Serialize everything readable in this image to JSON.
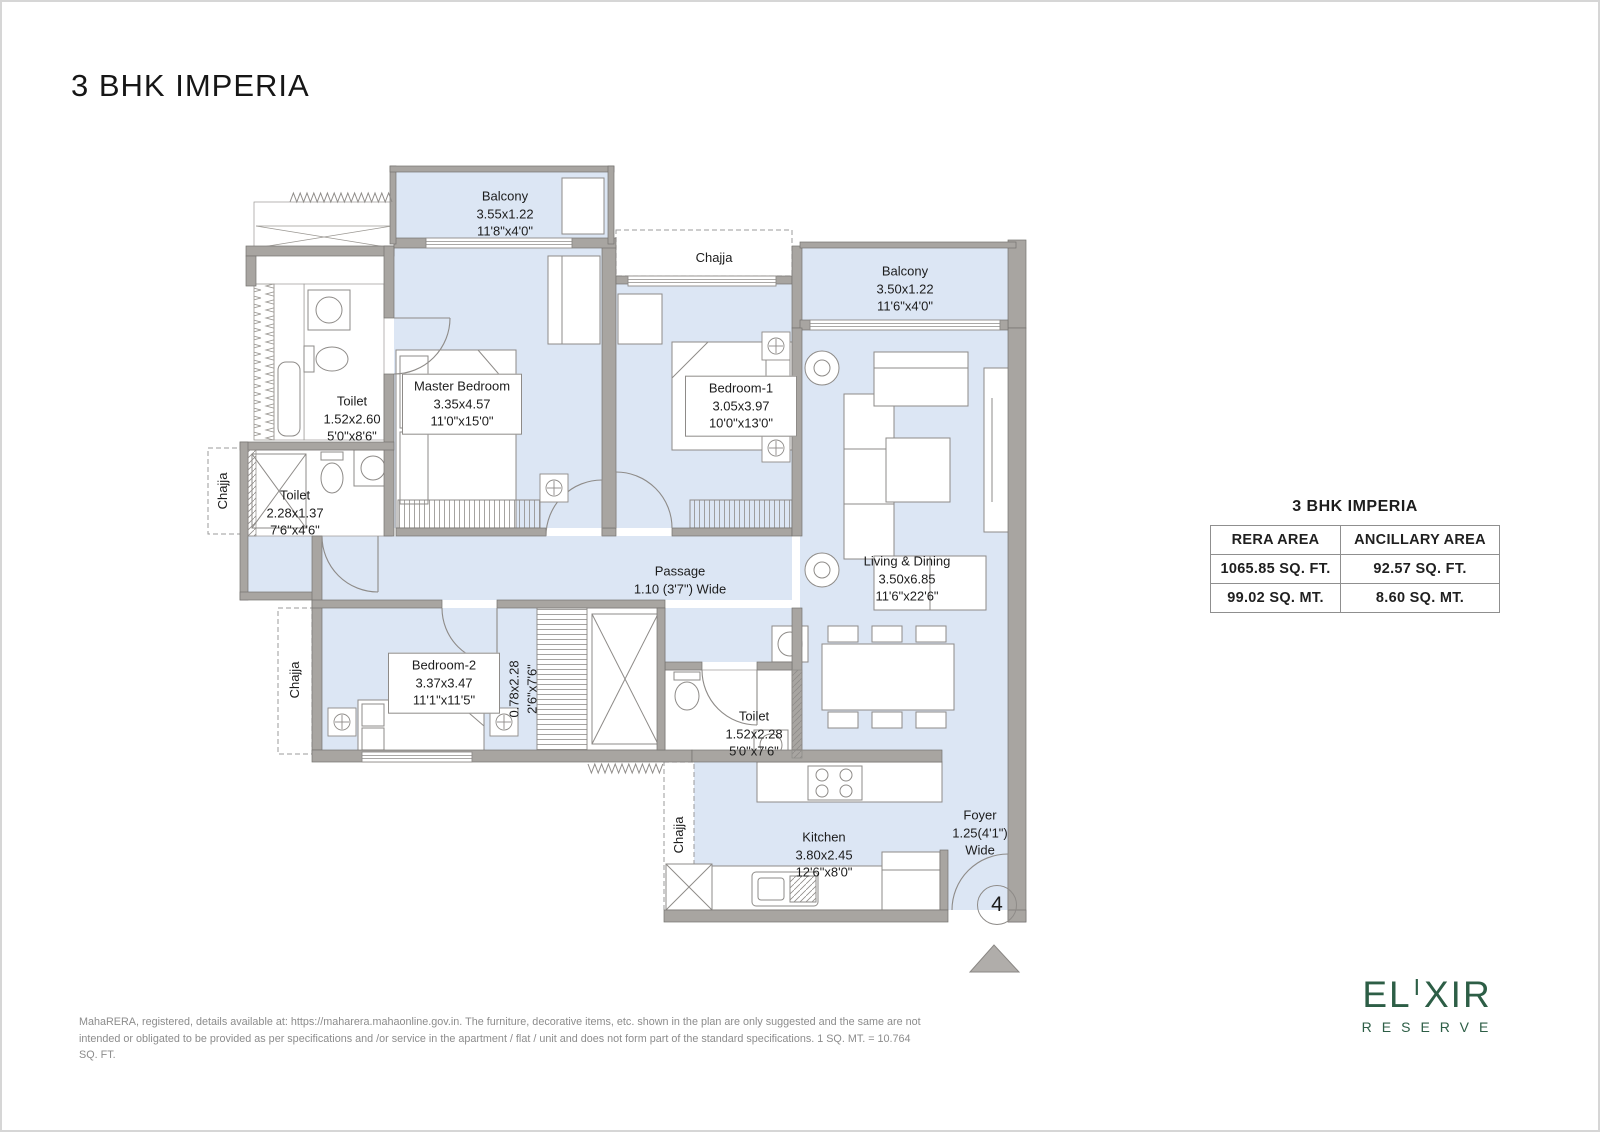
{
  "page": {
    "title": "3 BHK IMPERIA"
  },
  "plan": {
    "labels": {
      "balcony_top": {
        "name": "Balcony",
        "metric": "3.55x1.22",
        "imperial": "11'8\"x4'0\""
      },
      "chajja_top": {
        "name": "Chajja"
      },
      "balcony_right": {
        "name": "Balcony",
        "metric": "3.50x1.22",
        "imperial": "11'6\"x4'0\""
      },
      "toilet_master": {
        "name": "Toilet",
        "metric": "1.52x2.60",
        "imperial": "5'0\"x8'6\""
      },
      "toilet_common": {
        "name": "Toilet",
        "metric": "2.28x1.37",
        "imperial": "7'6\"x4'6\""
      },
      "master_bedroom": {
        "name": "Master Bedroom",
        "metric": "3.35x4.57",
        "imperial": "11'0\"x15'0\""
      },
      "bedroom_1": {
        "name": "Bedroom-1",
        "metric": "3.05x3.97",
        "imperial": "10'0\"x13'0\""
      },
      "bedroom_2": {
        "name": "Bedroom-2",
        "metric": "3.37x3.47",
        "imperial": "11'1\"x11'5\""
      },
      "chajja_left": {
        "name": "Chajja"
      },
      "chajja_left_lower": {
        "name": "Chajja"
      },
      "chajja_bottom": {
        "name": "Chajja"
      },
      "passage": {
        "name": "Passage",
        "dims": "1.10 (3'7\") Wide"
      },
      "living_dining": {
        "name": "Living & Dining",
        "metric": "3.50x6.85",
        "imperial": "11'6\"x22'6\""
      },
      "wardrobe": {
        "metric": "0.78x2.28",
        "imperial": "2'6\"x7'6\""
      },
      "toilet_bed2": {
        "name": "Toilet",
        "metric": "1.52x2.28",
        "imperial": "5'0\"x7'6\""
      },
      "kitchen": {
        "name": "Kitchen",
        "metric": "3.80x2.45",
        "imperial": "12'6\"x8'0\""
      },
      "foyer": {
        "name": "Foyer",
        "dims": "1.25(4'1\")",
        "dims2": "Wide"
      },
      "unit_number": "4"
    }
  },
  "area_table": {
    "title": "3 BHK IMPERIA",
    "col1_header": "RERA AREA",
    "col2_header": "ANCILLARY AREA",
    "rows": [
      {
        "rera": "1065.85 SQ. FT.",
        "ancillary": "92.57 SQ. FT."
      },
      {
        "rera": "99.02 SQ. MT.",
        "ancillary": "8.60 SQ. MT."
      }
    ]
  },
  "footer": {
    "disclaimer": "MahaRERA, registered, details available at: https://maharera.mahaonline.gov.in. The furniture, decorative items, etc. shown in the plan are only suggested and the same are not intended or obligated to be provided as per specifications and /or service in the apartment / flat / unit and does not form part of the standard specifications. 1 SQ. MT. = 10.764 SQ. FT."
  },
  "logo": {
    "word_start": "EL",
    "word_raised": "I",
    "word_end": "XIR",
    "tagline": "RESERVE"
  },
  "colors": {
    "floor_fill": "#dce6f4",
    "wall_fill": "#a8a5a1",
    "logo_green": "#2d5e46"
  }
}
